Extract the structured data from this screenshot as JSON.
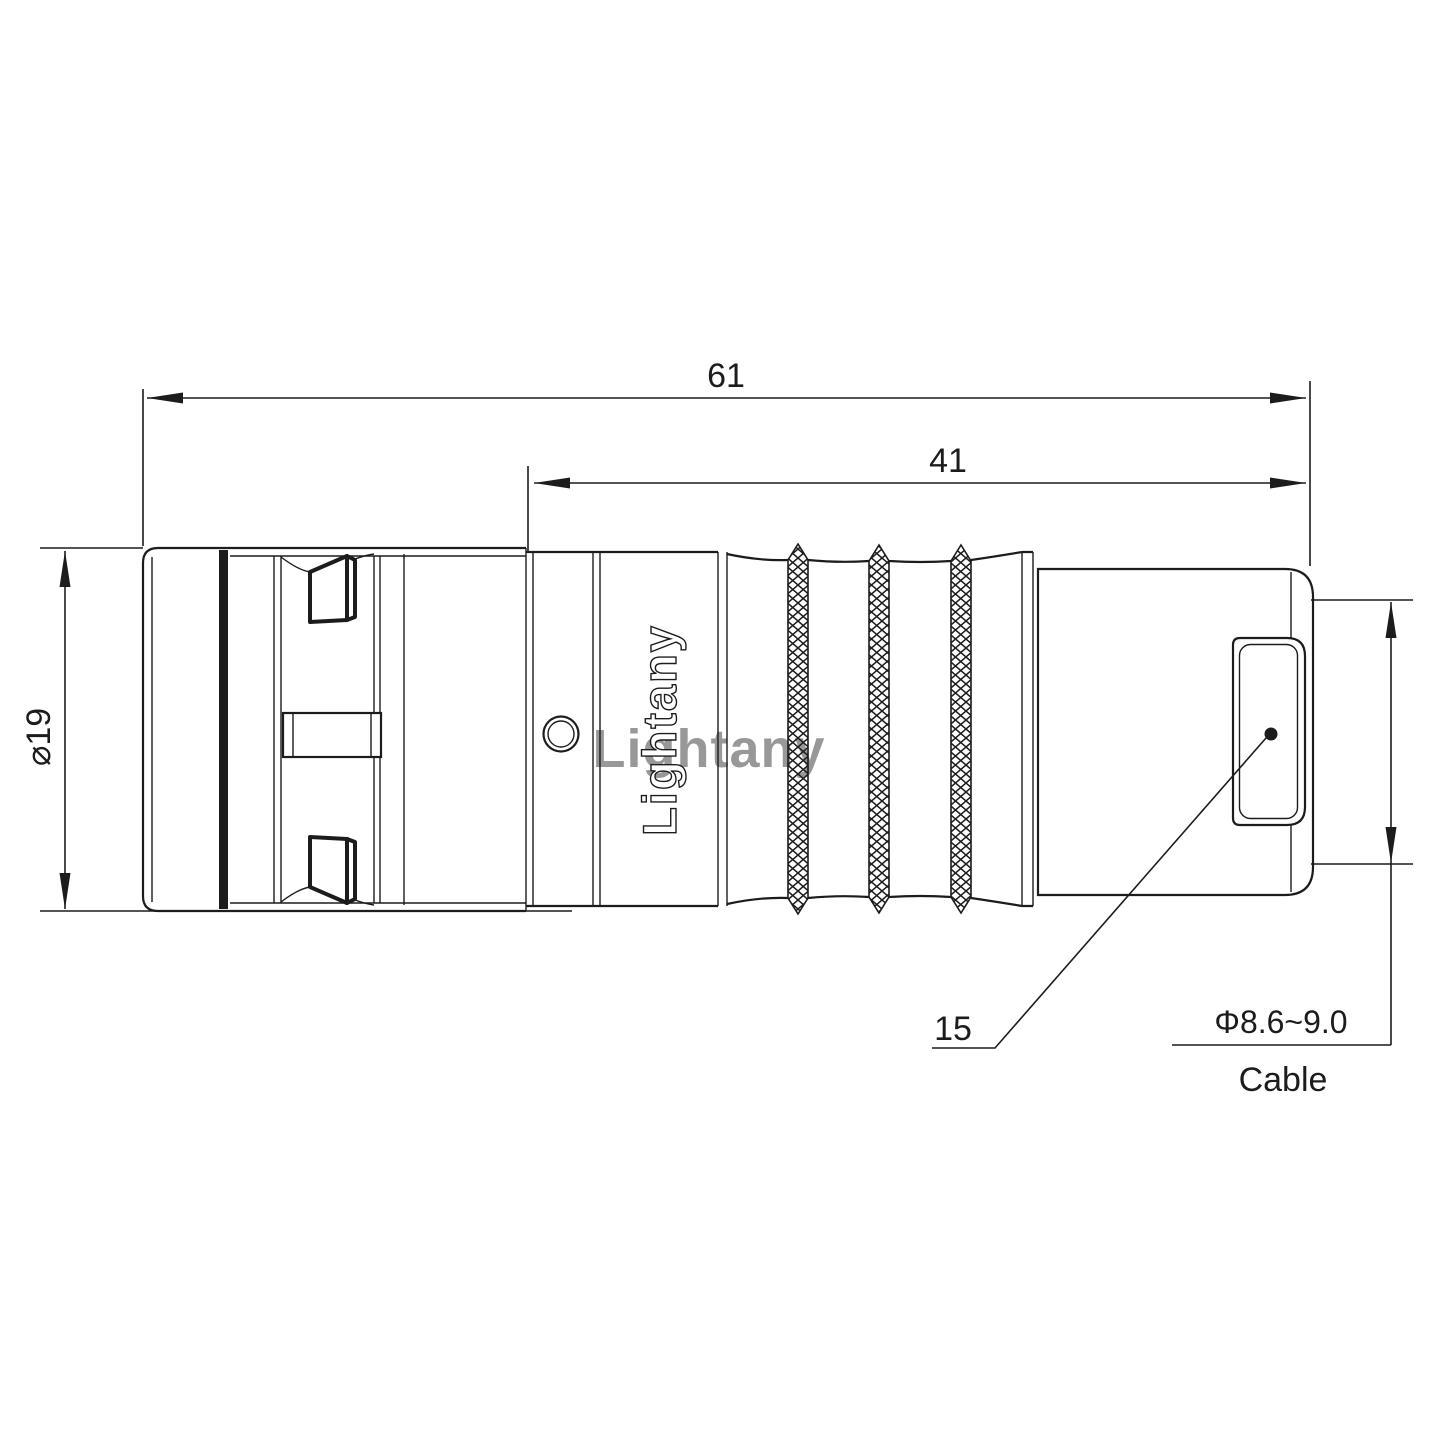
{
  "dimensions": {
    "total_length": "61",
    "body_length": "41",
    "outer_diameter": "⌀19",
    "backnut_ref": "15",
    "cable_diameter": "Φ8.6~9.0",
    "cable_label": "Cable"
  },
  "branding": {
    "engraved_logo": "Lightany",
    "watermark": "Lightany"
  },
  "colors": {
    "line": "#1c1c1c",
    "watermark_pink": "#e08f8f",
    "background": "#ffffff"
  }
}
